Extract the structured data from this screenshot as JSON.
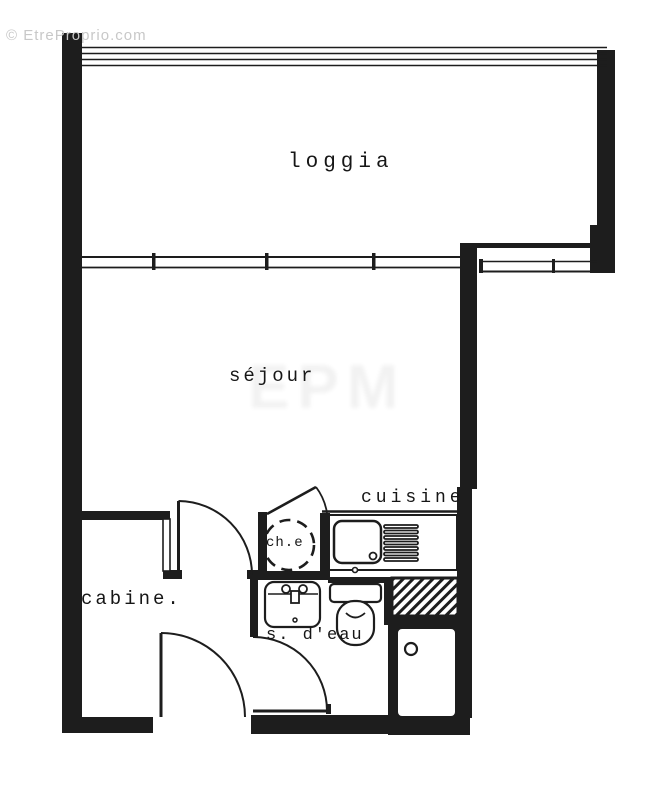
{
  "watermark": {
    "text": "© EtreProprio.com",
    "ghost": "EPM"
  },
  "rooms": {
    "loggia": "loggia",
    "sejour": "séjour",
    "cuisine": "cuisine",
    "cabine": "cabine.",
    "water_heater": "ch.e",
    "shower_room": "s. d'eau"
  },
  "colors": {
    "wall": "#1d1d1d",
    "paper": "#ffffff",
    "watermark": "#c8c8c8"
  }
}
